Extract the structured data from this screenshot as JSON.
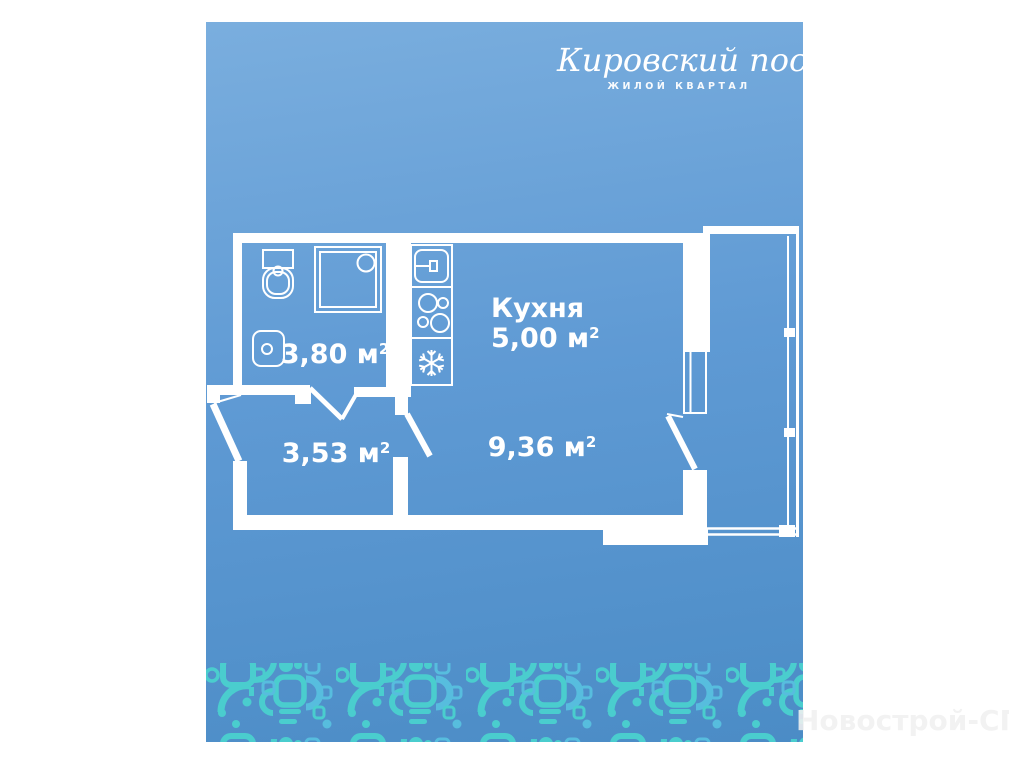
{
  "theme": {
    "g1": "#7aaede",
    "g2": "#5f9ad4",
    "g3": "#4b8cc6",
    "wall": "#ffffff",
    "p1": "#4ad3ce",
    "p2": "#58c1e0",
    "wm": "#f1f1f1"
  },
  "logo": {
    "title": "Кировский посад",
    "subtitle": "ЖИЛОЙ КВАРТАЛ"
  },
  "floorplan": {
    "rooms": {
      "bathroom": {
        "area": "3,80 м",
        "sup": "2"
      },
      "hallway": {
        "area": "3,53 м",
        "sup": "2"
      },
      "kitchen": {
        "name": "Кухня",
        "area": "5,00 м",
        "sup": "2"
      },
      "living_room": {
        "area": "9,36 м",
        "sup": "2"
      }
    },
    "fixtures": [
      "toilet",
      "shower-cabin",
      "washbasin",
      "kitchen-sink",
      "stove",
      "fridge-snowflake"
    ],
    "features": [
      "entrance-door",
      "bathroom-door",
      "living-room-door",
      "balcony-door",
      "window",
      "balcony"
    ]
  },
  "watermark": {
    "text": "Новострой-СПб"
  }
}
